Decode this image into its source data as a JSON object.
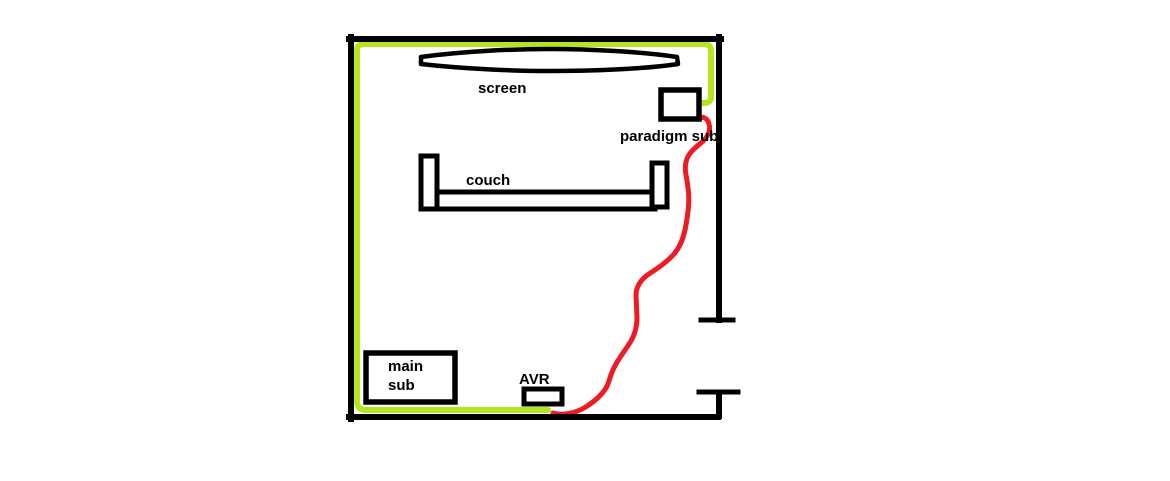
{
  "canvas": {
    "background": "#ffffff"
  },
  "colors": {
    "wall": "#000000",
    "furniture_outline": "#000000",
    "speaker_wire_green": "#b5e61d",
    "sub_cable_red": "#ed1c24",
    "label_text": "#000000"
  },
  "labels": {
    "screen": "screen",
    "paradigm_sub": "paradigm sub",
    "couch": "couch",
    "main_sub": [
      "main",
      "sub"
    ],
    "avr": "AVR"
  }
}
